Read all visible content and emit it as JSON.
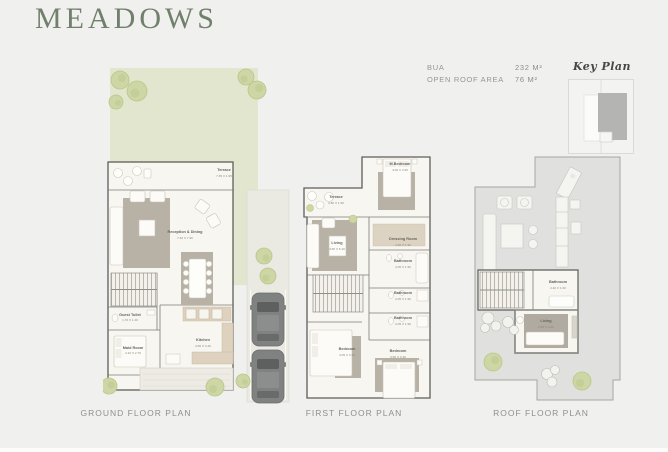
{
  "page": {
    "title": "MEADOWS"
  },
  "specs": {
    "bua_label": "BUA",
    "bua_value": "232 M²",
    "open_roof_label": "OPEN ROOF AREA",
    "open_roof_value": "76 M²"
  },
  "key_plan": {
    "title": "Key Plan"
  },
  "plans": {
    "ground": {
      "title": "GROUND FLOOR PLAN",
      "rooms": [
        {
          "name": "Terrace",
          "dims": "7.35 X 1.95"
        },
        {
          "name": "Reception & Dining",
          "dims": "7.40 X 7.90"
        },
        {
          "name": "Guest Toilet",
          "dims": "1.70 X 1.40"
        },
        {
          "name": "Maid Room",
          "dims": "2.10 X 2.70"
        },
        {
          "name": "Kitchen",
          "dims": "3.60 X 3.40"
        }
      ]
    },
    "first": {
      "title": "FIRST FLOOR PLAN",
      "rooms": [
        {
          "name": "M.Bedroom",
          "dims": "4.00 X 3.95"
        },
        {
          "name": "Terrace",
          "dims": "2.80 X 1.50"
        },
        {
          "name": "Living",
          "dims": "3.80 X 5.10"
        },
        {
          "name": "Dressing Room",
          "dims": "2.60 X 1.90"
        },
        {
          "name": "Bathroom",
          "dims": "2.05 X 1.90"
        },
        {
          "name": "Bathroom",
          "dims": "2.05 X 1.90"
        },
        {
          "name": "Bathroom",
          "dims": "2.05 X 1.90"
        },
        {
          "name": "Bedroom",
          "dims": "4.05 X 3.40"
        },
        {
          "name": "Bedroom",
          "dims": "3.60 X 3.40"
        }
      ]
    },
    "roof": {
      "title": "ROOF FLOOR PLAN",
      "rooms": [
        {
          "name": "Bathroom",
          "dims": "2.40 X 1.60"
        },
        {
          "name": "Living",
          "dims": "3.55 X 3.40"
        }
      ]
    }
  },
  "colors": {
    "title_green": "#70806c",
    "garden_green": "#e2e6ce",
    "tree_green": "#cdd6a4",
    "floor_cream": "#f8f6f0",
    "wall_gray": "#5e5e59",
    "rug_gray": "#b7b1a6",
    "roof_gray": "#e0e0de",
    "keyplan_fill": "#b4b4b2"
  }
}
